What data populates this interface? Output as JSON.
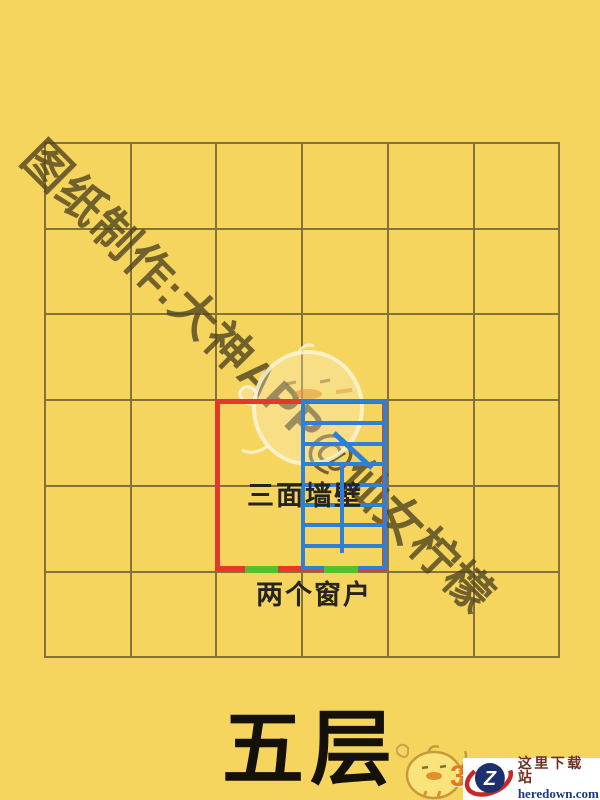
{
  "blueprint": {
    "bg_color": "#f6d55f",
    "floor_label": "五层",
    "walls_label": "三面墙壁",
    "windows_label": "两个窗户",
    "watermark": "图纸制作:大神APP@仙女柠檬",
    "grid": {
      "cols": 6,
      "rows": 6,
      "x0": 44,
      "y0": 142,
      "cell_w": 85.7,
      "cell_h": 85.7,
      "line_color": "#85713a",
      "line_px": 2
    },
    "room": {
      "x": 215,
      "y": 399,
      "w": 172,
      "h": 172,
      "outline_color": "#e2392b",
      "outline_px": 5
    },
    "stairs": {
      "x": 301,
      "y": 399,
      "w": 86,
      "h": 171,
      "color": "#2e7fd6",
      "border_px": 4,
      "rungs": 7,
      "divider_from": 462,
      "divider_to": 553,
      "divider_x": 340,
      "diag": {
        "x1": 334,
        "y1": 433,
        "x2": 372,
        "y2": 468
      }
    },
    "window_color": "#55c02e",
    "windows": [
      {
        "x": 245,
        "w": 33,
        "y": 566
      },
      {
        "x": 324,
        "w": 34,
        "y": 566
      }
    ]
  },
  "footer": {
    "site_name": "这里下载站",
    "site_domain": "heredown.com",
    "logo_letter": "Z",
    "badge_number": "3"
  }
}
